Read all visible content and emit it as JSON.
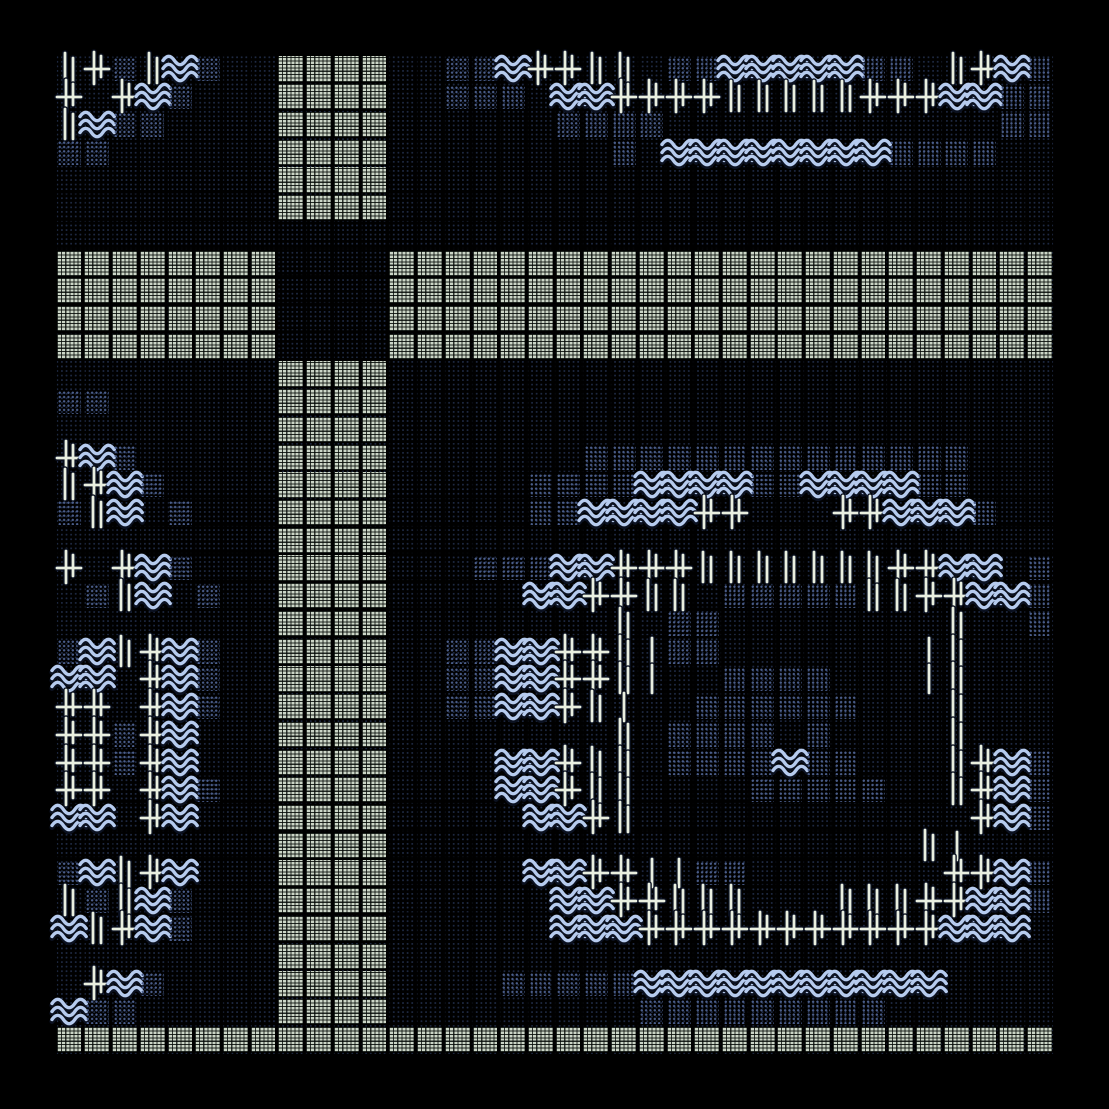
{
  "artwork": {
    "kind": "generative-textmode-grid-art",
    "background": "#000000",
    "palette": {
      "light_tile": "#ccd6c7",
      "tile_weave_line": "#050906",
      "dark_dot": "#4b5e8b",
      "faint_dot": "#1e2942",
      "wave": "#b6cbee",
      "glyph": "#e9efe0",
      "glyph_shadow": "#0b1120"
    },
    "legend": {
      ".": "faint-dots-cell",
      "L": "light-tile",
      "D": "dark-dots-tile",
      "W": "wave-glyph",
      "C": "cross-glyph",
      "B": "double-bar-glyph",
      "I": "single-bar-glyph"
    },
    "grid": {
      "cols": 36,
      "rows": 36,
      "cell_px": 27.725,
      "origin_px": 55.45,
      "map": [
        "BCDBWD..LLLL..DDWCCBB.DDWWWWWDD.BCWD",
        "C.CWD...LLLL..DDD.WWCCCCBBBBBCCCWWDD",
        "BWDD....LLLL......DDDD............DD",
        "DD......LLLL........D.WWWWWWWWDDDD..",
        "........LLLL........................",
        "........LLLL........................",
        "....................................",
        "LLLLLLLL....LLLLLLLLLLLLLLLLLLLLLLLL",
        "LLLLLLLL....LLLLLLLLLLLLLLLLLLLLLLLL",
        "LLLLLLLL....LLLLLLLLLLLLLLLLLLLLLLLL",
        "LLLLLLLL....LLLLLLLLLLLLLLLLLLLLLLLL",
        "........LLLL........................",
        "DD......LLLL........................",
        "........LLLL........................",
        "CWD.....LLLL.......DDDDDDDDDDDDDD...",
        "BCWD....LLLL.....DDDDWWWWDDWWWWDD...",
        "DBW.D...LLLL.....DDWWWWCC...CCWWWD..",
        "........LLLL........................",
        "C.CWD...LLLL...DDDWWCCCBBBBBBBCCWW.D",
        ".DBW.D..LLLL.....WWCCBB.DDDDDBBCCWWD",
        "........LLLL........B.DD........B..D",
        "DWBCWD..LLLL..DDWWCCBIDD.......IB...",
        "WW.CWD..LLLL..DDWWCCBI..DDDD...IB...",
        "CC.CWD..LLLL..DDWWCBI..DDDDDD...B...",
        "CCDCW...LLLL........B.DDDD.D....B...",
        "CCDCW...LLLL....WWCBB.DDDDWDD...BCWD",
        "CC.CWD..LLLL....WWCBB....DDDDD..BCWD",
        "WW.CW...LLLL.....WWCB............CWD",
        "........LLLL...................BI...",
        "DWBCW...LLLL.....WWCCIIDD.......CCWD",
        "BDBWD...LLLL......WWCCBBB...BBBCCWWD",
        "WBCWD...LLLL......WWWCCCCCCCCCCCWWW.",
        "........LLLL........................",
        ".CWD....LLLL....DDDDDWWWWWWWWWWW....",
        "WDD.....LLLL.........DDDDDDDDD......",
        "LLLLLLLLLLLLLLLLLLLLLLLLLLLLLLLLLLLL"
      ]
    }
  }
}
